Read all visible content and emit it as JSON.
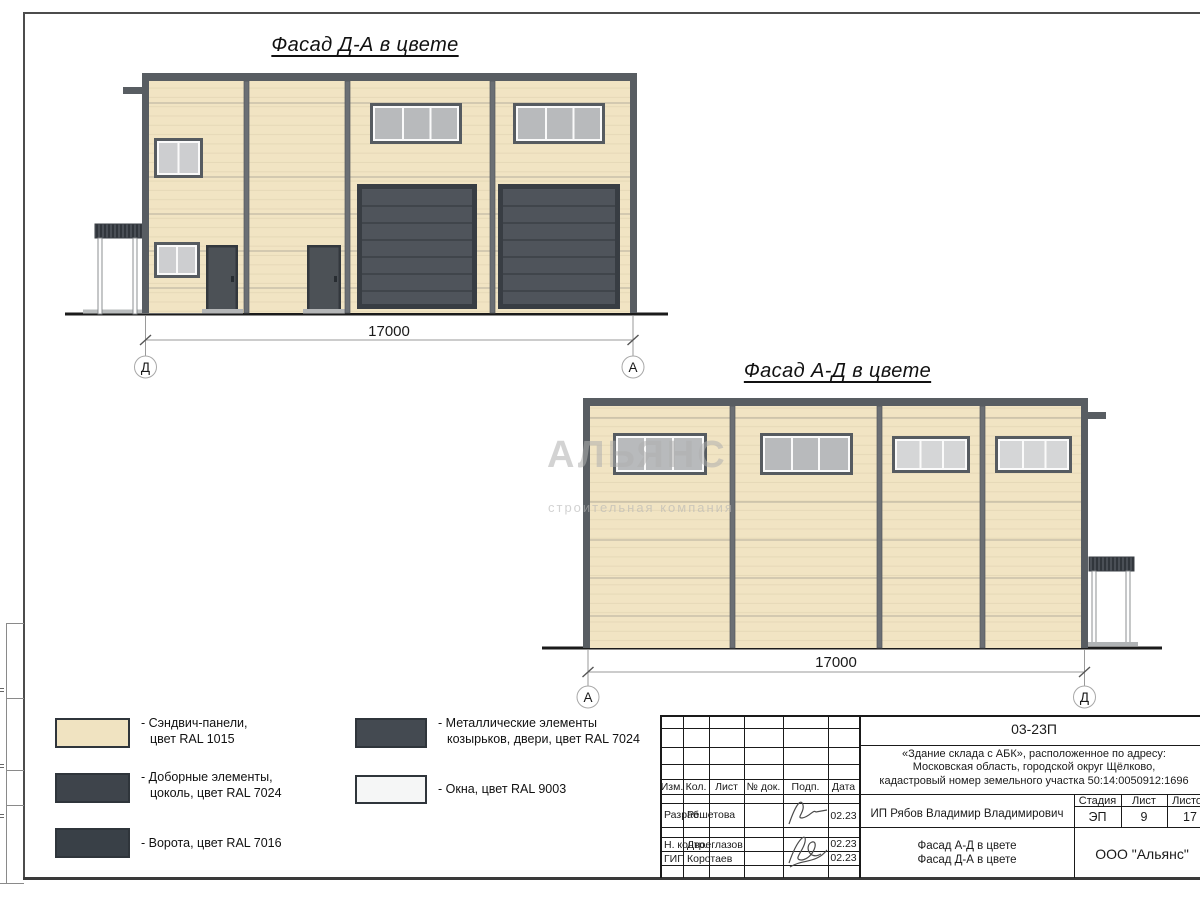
{
  "document": {
    "facade_da": {
      "title": "Фасад Д-А в цвете",
      "dimension": "17000",
      "axis_left": "Д",
      "axis_right": "А"
    },
    "facade_ad": {
      "title": "Фасад А-Д в цвете",
      "dimension": "17000",
      "axis_left": "А",
      "axis_right": "Д"
    }
  },
  "watermark": {
    "line1": "АЛЬЯНС",
    "line2": "строительная компания"
  },
  "legend": {
    "items": [
      {
        "color": "#f0e3c1",
        "line1": "- Сэндвич-панели,",
        "line2": "цвет RAL 1015"
      },
      {
        "color": "#3e444b",
        "line1": "- Доборные элементы,",
        "line2": "цоколь, цвет RAL 7024"
      },
      {
        "color": "#394047",
        "line1": "- Ворота, цвет RAL 7016",
        "line2": ""
      },
      {
        "color": "#444a51",
        "line1": "- Металлические элементы",
        "line2": "козырьков, двери, цвет RAL 7024"
      },
      {
        "color": "#f5f6f6",
        "line1": "- Окна, цвет RAL 9003",
        "line2": ""
      }
    ]
  },
  "title_block": {
    "doc_number": "03-23П",
    "description_line1": "«Здание склада с АБК», расположенное по адресу:",
    "description_line2": "Московская область, городской округ Щёлково,",
    "description_line3": "кадастровый номер земельного участка 50:14:0050912:1696",
    "col_izm": "Изм.",
    "col_kol": "Кол.",
    "col_list": "Лист",
    "col_doc": "№ док.",
    "col_podp": "Подп.",
    "col_data": "Дата",
    "sign_rows": [
      {
        "role": "Разраб.",
        "name": "Решетова",
        "date": "02.23"
      },
      {
        "role": "Н. контр.",
        "name": "Двоеглазов",
        "date": "02.23"
      },
      {
        "role": "ГИП",
        "name": "Коротаев",
        "date": "02.23"
      }
    ],
    "client": "ИП Рябов Владимир Владимирович",
    "stage_label": "Стадия",
    "sheet_label": "Лист",
    "sheets_label": "Листов",
    "stage_value": "ЭП",
    "sheet_value": "9",
    "sheets_value": "17",
    "sheet_title_line1": "Фасад А-Д в цвете",
    "sheet_title_line2": "Фасад Д-А в цвете",
    "company": "ООО \"Альянс\""
  },
  "colors": {
    "sandwich_panel": "#f0e3c1",
    "trim_elements": "#3e444b",
    "gate": "#394047",
    "metal_elements": "#444a51",
    "window": "#f5f6f6",
    "frame_gray": "#585d62"
  }
}
